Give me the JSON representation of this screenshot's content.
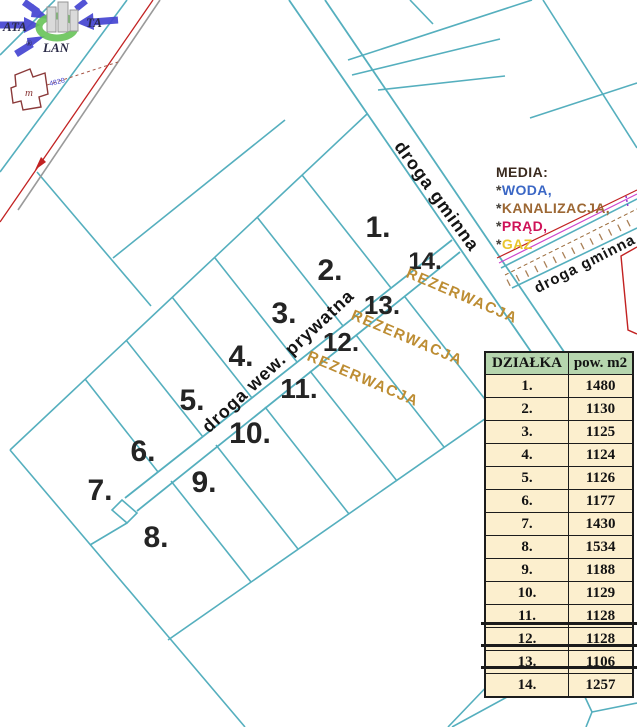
{
  "map": {
    "road_gminna_label": "droga gminna",
    "road_prywatna_label": "droga wew. prywatna",
    "reservation_label": "REZERWACJA",
    "building_label": "m",
    "building_code": "4828",
    "parcel_labels": [
      "1.",
      "2.",
      "3.",
      "4.",
      "5.",
      "6.",
      "7.",
      "8.",
      "9.",
      "10.",
      "11.",
      "12.",
      "13.",
      "14."
    ]
  },
  "legend": {
    "title": "MEDIA:",
    "items": [
      {
        "star": "*",
        "label": "WODA,",
        "color": "#3b67c5"
      },
      {
        "star": "*",
        "label": "KANALIZACJA,",
        "color": "#9c6733"
      },
      {
        "star": "*",
        "label": "PRĄD,",
        "color": "#cf1258"
      },
      {
        "star": "*",
        "label": "GAZ",
        "color": "#e9c52d"
      }
    ]
  },
  "table": {
    "headers": [
      "DZIAŁKA",
      "pow. m2"
    ],
    "rows": [
      {
        "no": "1.",
        "area": "1480",
        "struck": false
      },
      {
        "no": "2.",
        "area": "1130",
        "struck": false
      },
      {
        "no": "3.",
        "area": "1125",
        "struck": false
      },
      {
        "no": "4.",
        "area": "1124",
        "struck": false
      },
      {
        "no": "5.",
        "area": "1126",
        "struck": false
      },
      {
        "no": "6.",
        "area": "1177",
        "struck": false
      },
      {
        "no": "7.",
        "area": "1430",
        "struck": false
      },
      {
        "no": "8.",
        "area": "1534",
        "struck": false
      },
      {
        "no": "9.",
        "area": "1188",
        "struck": false
      },
      {
        "no": "10.",
        "area": "1129",
        "struck": false
      },
      {
        "no": "11.",
        "area": "1128",
        "struck": false
      },
      {
        "no": "12.",
        "area": "1128",
        "struck": true
      },
      {
        "no": "13.",
        "area": "1106",
        "struck": true
      },
      {
        "no": "14.",
        "area": "1257",
        "struck": true
      }
    ]
  },
  "logo": {
    "text_left": "ATA",
    "text_right": "TA",
    "text_bottom": "LAN",
    "registered": "®"
  },
  "colors": {
    "parcel_line": "#55afbe",
    "reservation_text": "#bd8d33",
    "table_header_bg": "#b6d5ae",
    "table_cell_bg": "#fcefce",
    "road_label": "#141414",
    "power_line_red": "#c22222",
    "utility_magenta": "#cc44cc",
    "utility_brown": "#9a6a3a"
  }
}
